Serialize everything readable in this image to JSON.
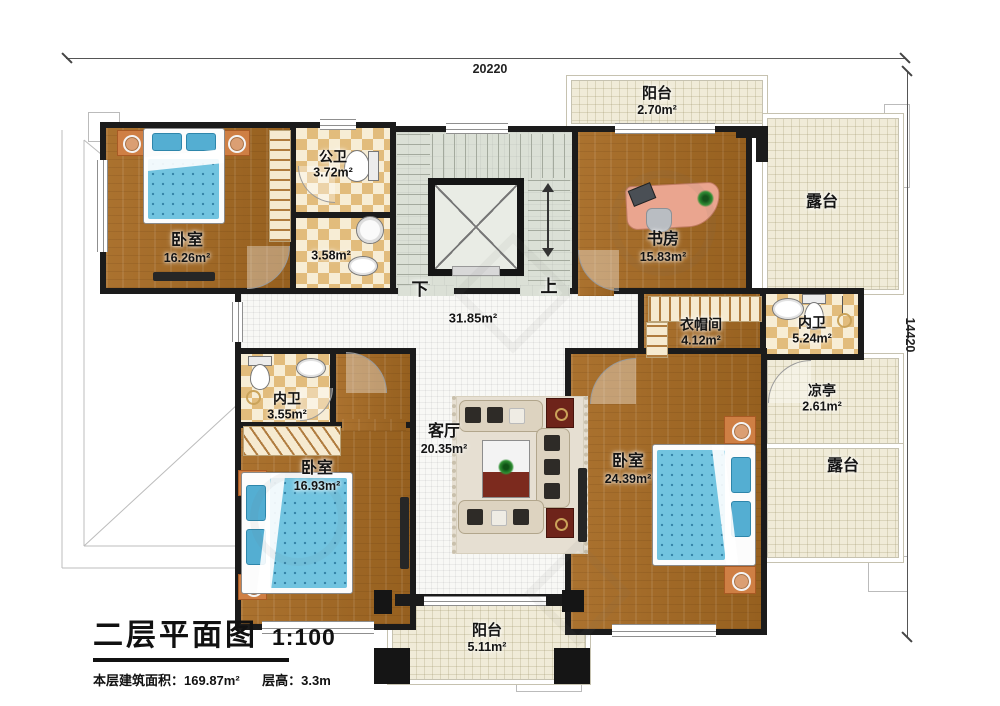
{
  "title_block": {
    "title": "二层平面图",
    "scale": "1:100",
    "area_label": "本层建筑面积：",
    "area_value": "169.87m²",
    "floor_height_label": "层高：",
    "floor_height_value": "3.3m"
  },
  "dimensions": {
    "top": "20220",
    "right": "14420"
  },
  "stair_labels": {
    "down": "下",
    "up": "上"
  },
  "rooms": {
    "bedroom_tl": {
      "name": "卧室",
      "area": "16.26m²"
    },
    "bath_top": {
      "name": "公卫",
      "area": "3.72m²"
    },
    "shower": {
      "area": "3.58m²"
    },
    "hall": {
      "area": "31.85m²"
    },
    "study": {
      "name": "书房",
      "area": "15.83m²"
    },
    "balcony_top": {
      "name": "阳台",
      "area": "2.70m²"
    },
    "terrace_top_right": {
      "name": "露台"
    },
    "wardrobe": {
      "name": "衣帽间",
      "area": "4.12m²"
    },
    "bath_right": {
      "name": "内卫",
      "area": "5.24m²"
    },
    "pavilion": {
      "name": "凉亭",
      "area": "2.61m²"
    },
    "terrace_right": {
      "name": "露台"
    },
    "bath_left": {
      "name": "内卫",
      "area": "3.55m²"
    },
    "bedroom_bl": {
      "name": "卧室",
      "area": "16.93m²"
    },
    "living": {
      "name": "客厅",
      "area": "20.35m²"
    },
    "bedroom_br": {
      "name": "卧室",
      "area": "24.39m²"
    },
    "balcony_bottom": {
      "name": "阳台",
      "area": "5.11m²"
    }
  },
  "colors": {
    "wall": "#1b1b1b",
    "wood_floor": "#a46c2c",
    "tile_dark": "#e2bc7c",
    "tile_light": "#f7edd5",
    "terrace_floor": "#f0ebd8",
    "stair_floor": "#dbe0d6",
    "bed_blue": "#72c4e0",
    "accent_orange": "#cf7f44"
  }
}
